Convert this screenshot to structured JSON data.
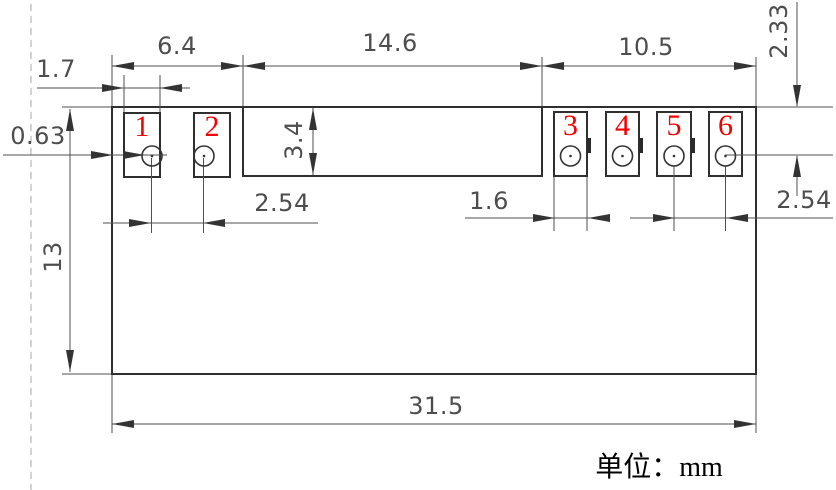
{
  "unit_label": "单位：mm",
  "pad_numbers": [
    "1",
    "2",
    "3",
    "4",
    "5",
    "6"
  ],
  "dimensions": {
    "pad_left_width": "1.7",
    "left_group_width": "6.4",
    "center_section_width": "14.6",
    "right_group_width": "10.5",
    "edge_to_pad_gap": "0.63",
    "notch_height": "3.4",
    "top_edge_to_hole_center": "2.33",
    "left_hole_pitch": "2.54",
    "pad_right_width": "1.6",
    "right_hole_pitch": "2.54",
    "body_height": "13",
    "body_width": "31.5"
  },
  "colors": {
    "outline": "#2f2f2f",
    "dimension_line": "#4f4f4f",
    "dimension_text": "#4d4d4d",
    "pad_number": "#f10000",
    "guide_line": "#b8b8b8",
    "background": "#ffffff"
  }
}
